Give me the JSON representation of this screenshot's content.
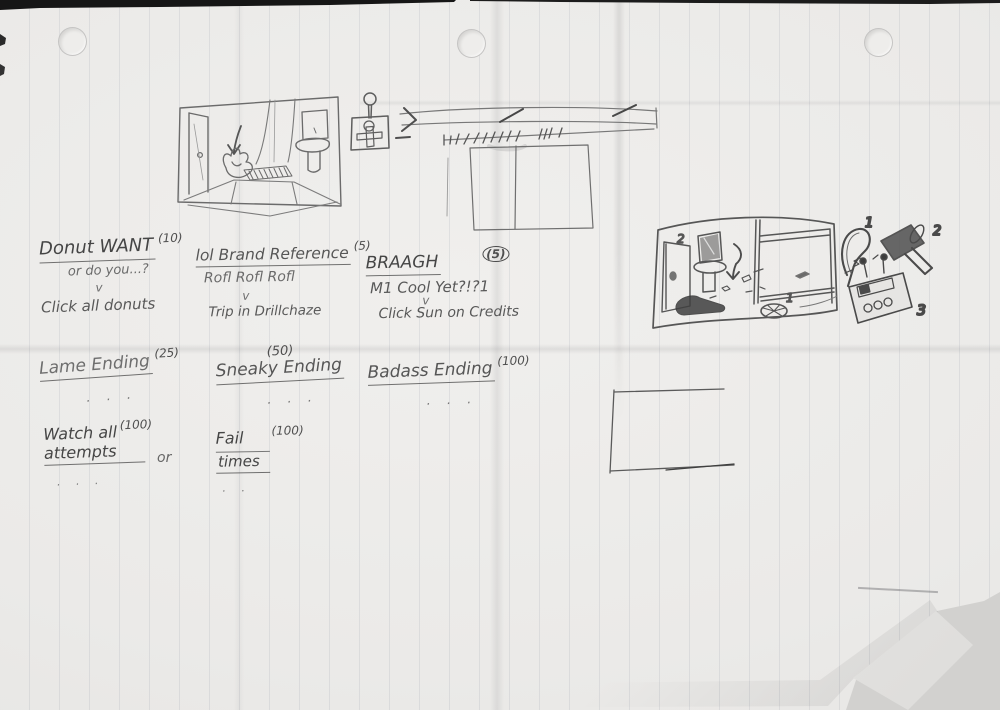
{
  "colors": {
    "paper": "#ebeae8",
    "outside": "#d2d1cf",
    "pencil": "#5c5c5c",
    "pencil_dark": "#454545",
    "rule": "rgba(105,115,135,0.12)"
  },
  "achievements": [
    {
      "title": "Donut WANT",
      "points": "(10)",
      "subtitle": "or do you...?",
      "arrow": "v",
      "desc": "Click all donuts"
    },
    {
      "title": "lol Brand Reference",
      "points": "(5)",
      "subtitle": "Rofl Rofl Rofl",
      "arrow": "v",
      "desc": "Trip in Drillchaze"
    },
    {
      "title": "BRAAGH",
      "points": "(5)",
      "subtitle": "M1 Cool Yet?!?1",
      "arrow": "v",
      "desc": "Click Sun on Credits"
    }
  ],
  "endings": [
    {
      "title": "Lame Ending",
      "points": "(25)",
      "dots": ". . ."
    },
    {
      "title": "Sneaky Ending",
      "points": "(50)",
      "dots": ". . ."
    },
    {
      "title": "Badass Ending",
      "points": "(100)",
      "dots": ". . ."
    }
  ],
  "meta": {
    "watch_line1": "Watch all",
    "watch_points": "(100)",
    "watch_line2": "attempts",
    "watch_dots": ". . .",
    "or": "or",
    "fail_line1": "Fail",
    "fail_points": "(100)",
    "fail_line2": "times",
    "fail_dots": ". ."
  },
  "sketch_labels": {
    "room_door": "2",
    "room_drain": "1",
    "item_hook": "1",
    "item_mallet": "2",
    "item_device": "3"
  }
}
